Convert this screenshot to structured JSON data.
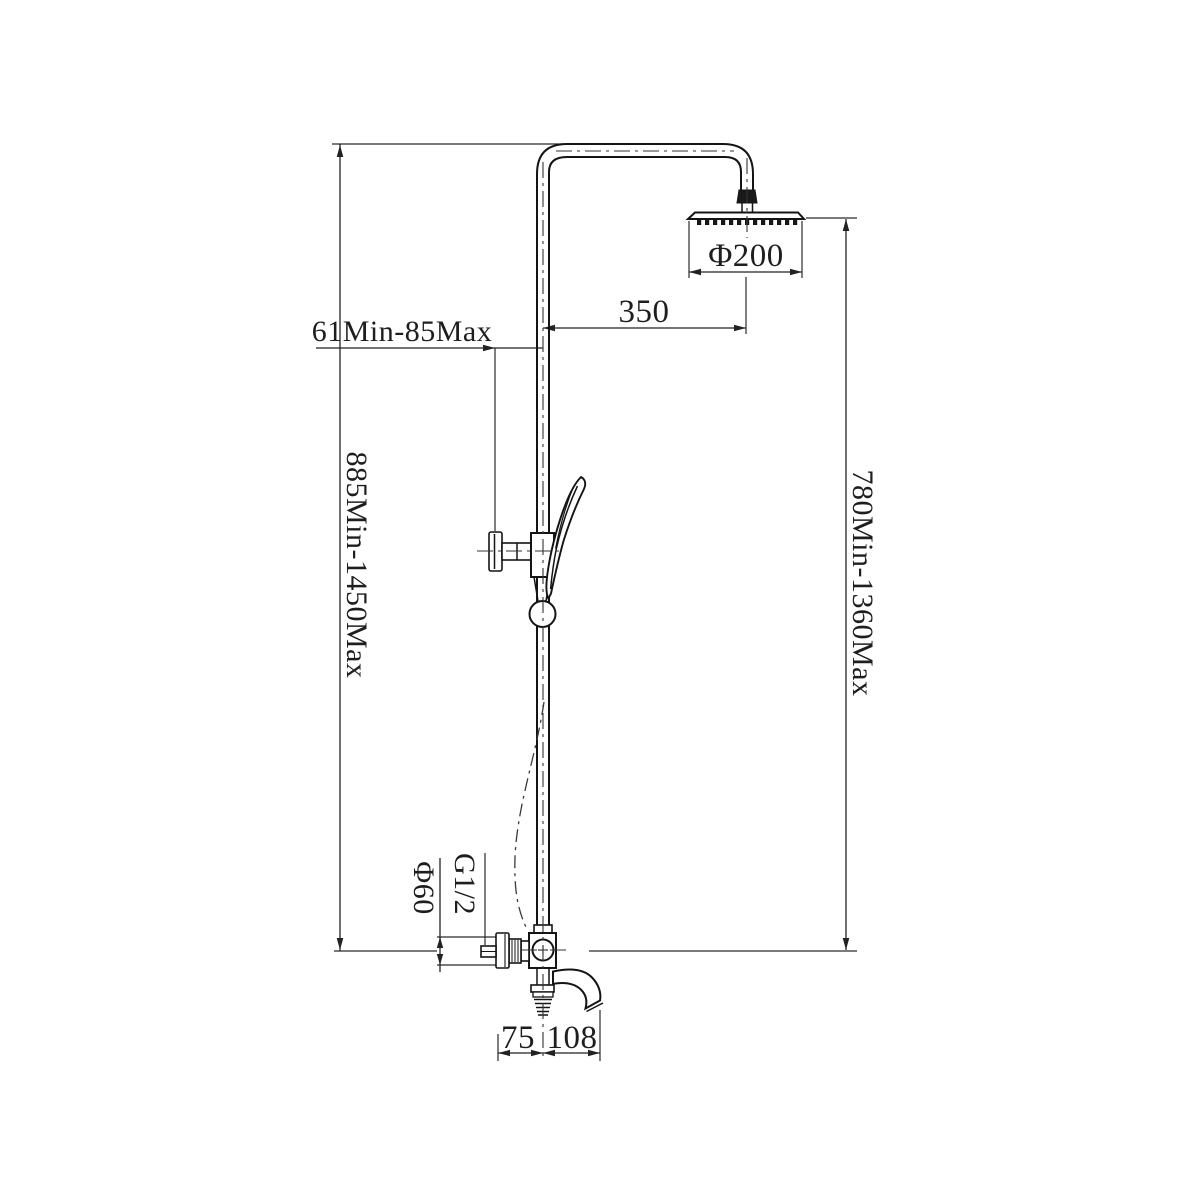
{
  "drawing": {
    "kind": "shower-system-technical-drawing",
    "background": "#ffffff",
    "line_color": "#141414",
    "dimension_line_color": "#222222",
    "text_color": "#1e1e1e",
    "dimensions": {
      "head_diameter": "Φ200",
      "head_offset_from_riser": "350",
      "bracket_depth_range": "61Min-85Max",
      "riser_height_range": "885Min-1450Max",
      "head_height_range": "780Min-1360Max",
      "handle_flange_diameter": "Φ60",
      "inlet_thread": "G1/2",
      "wall_to_riser_center": "75",
      "riser_center_to_spout": "108"
    }
  }
}
